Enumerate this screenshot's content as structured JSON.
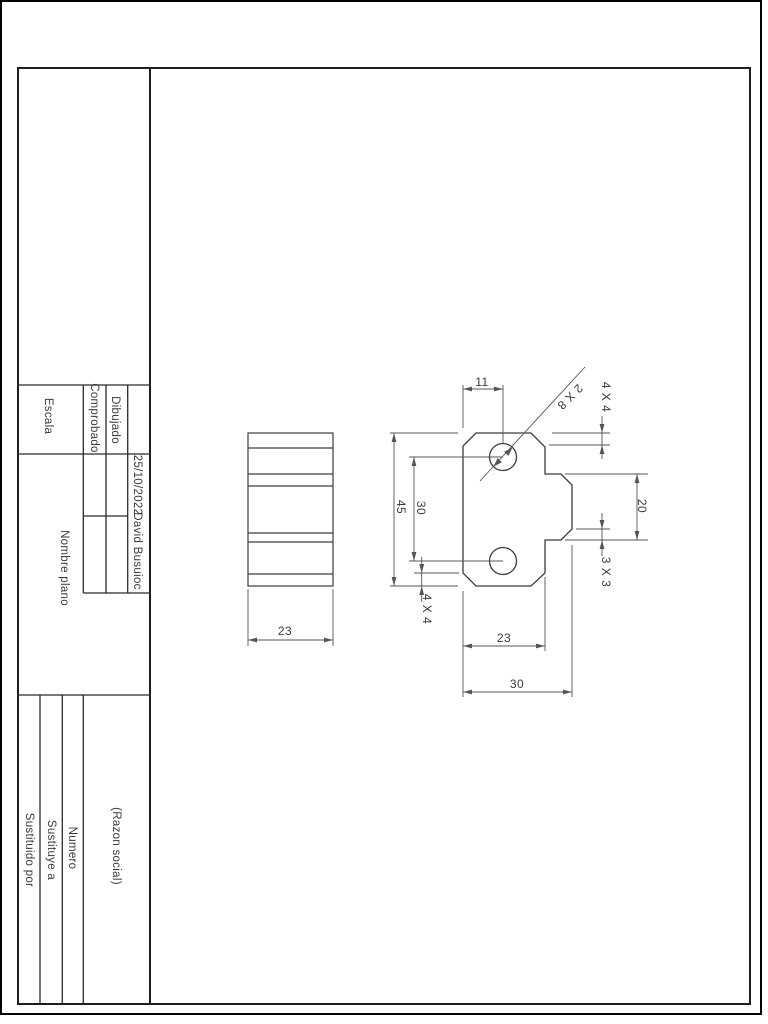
{
  "title_block": {
    "escala_label": "Escala",
    "comprobado_label": "Comprobado",
    "dibujado_label": "Dibujado",
    "date": "25/10/2022",
    "author": "David Busuioc",
    "nombre_plano_label": "Nombre plano",
    "razon_social_label": "(Razon social)",
    "numero_label": "Numero",
    "sustituye_a_label": "Sustituye a",
    "sustituido_por_label": "Sustituido por"
  },
  "drawing": {
    "dim_hole_offset": "11",
    "dim_total_height": "45",
    "dim_hole_spacing": "30",
    "dim_chamfer_bottom_left": "4 X 4",
    "dim_holes_note": "2 X 8",
    "dim_chamfer_top_right": "4 X 4",
    "dim_tab_width": "20",
    "dim_chamfer_tab": "3 X 3",
    "dim_body_width": "23",
    "dim_total_width": "30",
    "dim_side_depth": "23"
  },
  "colors": {
    "background": "#ffffff",
    "frame_line": "#1f1f1f",
    "drawing_line": "#3c3c3c",
    "dim_line": "#555555",
    "text": "#3a3a3a"
  }
}
